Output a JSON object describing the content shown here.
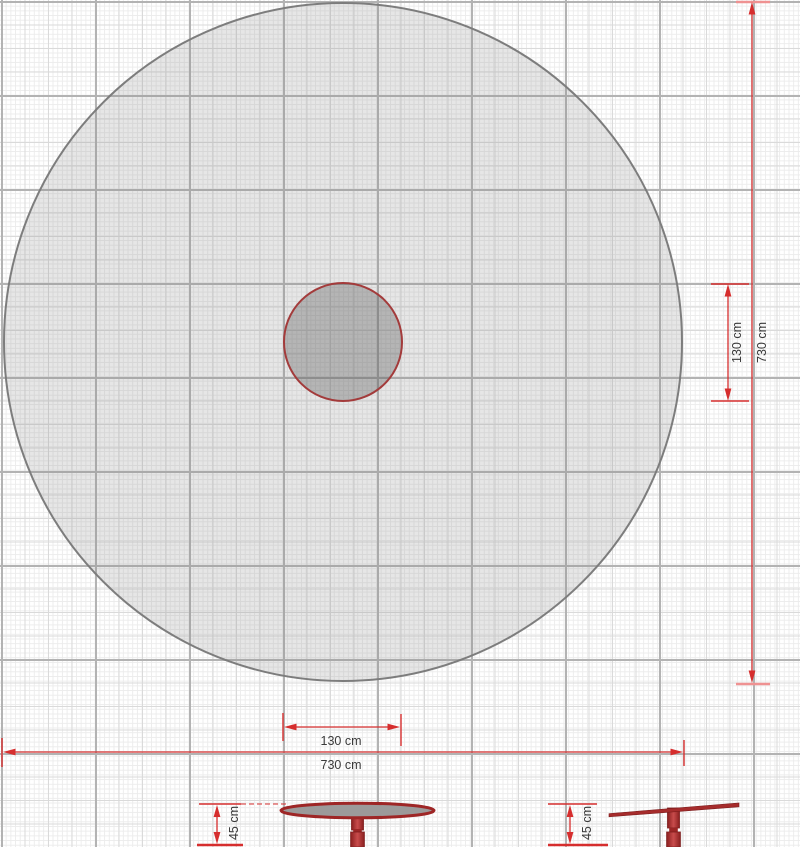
{
  "measurements": {
    "top_view": {
      "inner_diameter": {
        "label": "130 cm",
        "value_cm": 130
      },
      "outer_diameter": {
        "label": "730 cm",
        "value_cm": 730
      }
    },
    "bottom_scale": {
      "inner_width": {
        "label": "130 cm",
        "value_cm": 130
      },
      "outer_width": {
        "label": "730 cm",
        "value_cm": 730
      }
    },
    "front_view_height": {
      "label": "45 cm",
      "value_cm": 45
    },
    "side_view_height": {
      "label": "45 cm",
      "value_cm": 45
    }
  },
  "colors": {
    "dimension_red": "#d62e2e",
    "dimension_tick_light": "#ef9292",
    "equipment_red": "#a62c2c",
    "equipment_red_dark": "#7e1d1d",
    "zone_outline_gray": "#7d7d7d",
    "zone_fill_gray": "#e6e6e6",
    "equipment_top_fill": "#9c9a9a",
    "grid_major": "#b3b3b3",
    "grid_medium": "#dadada",
    "grid_minor": "#ececec",
    "label_text": "#3a3a3a"
  }
}
